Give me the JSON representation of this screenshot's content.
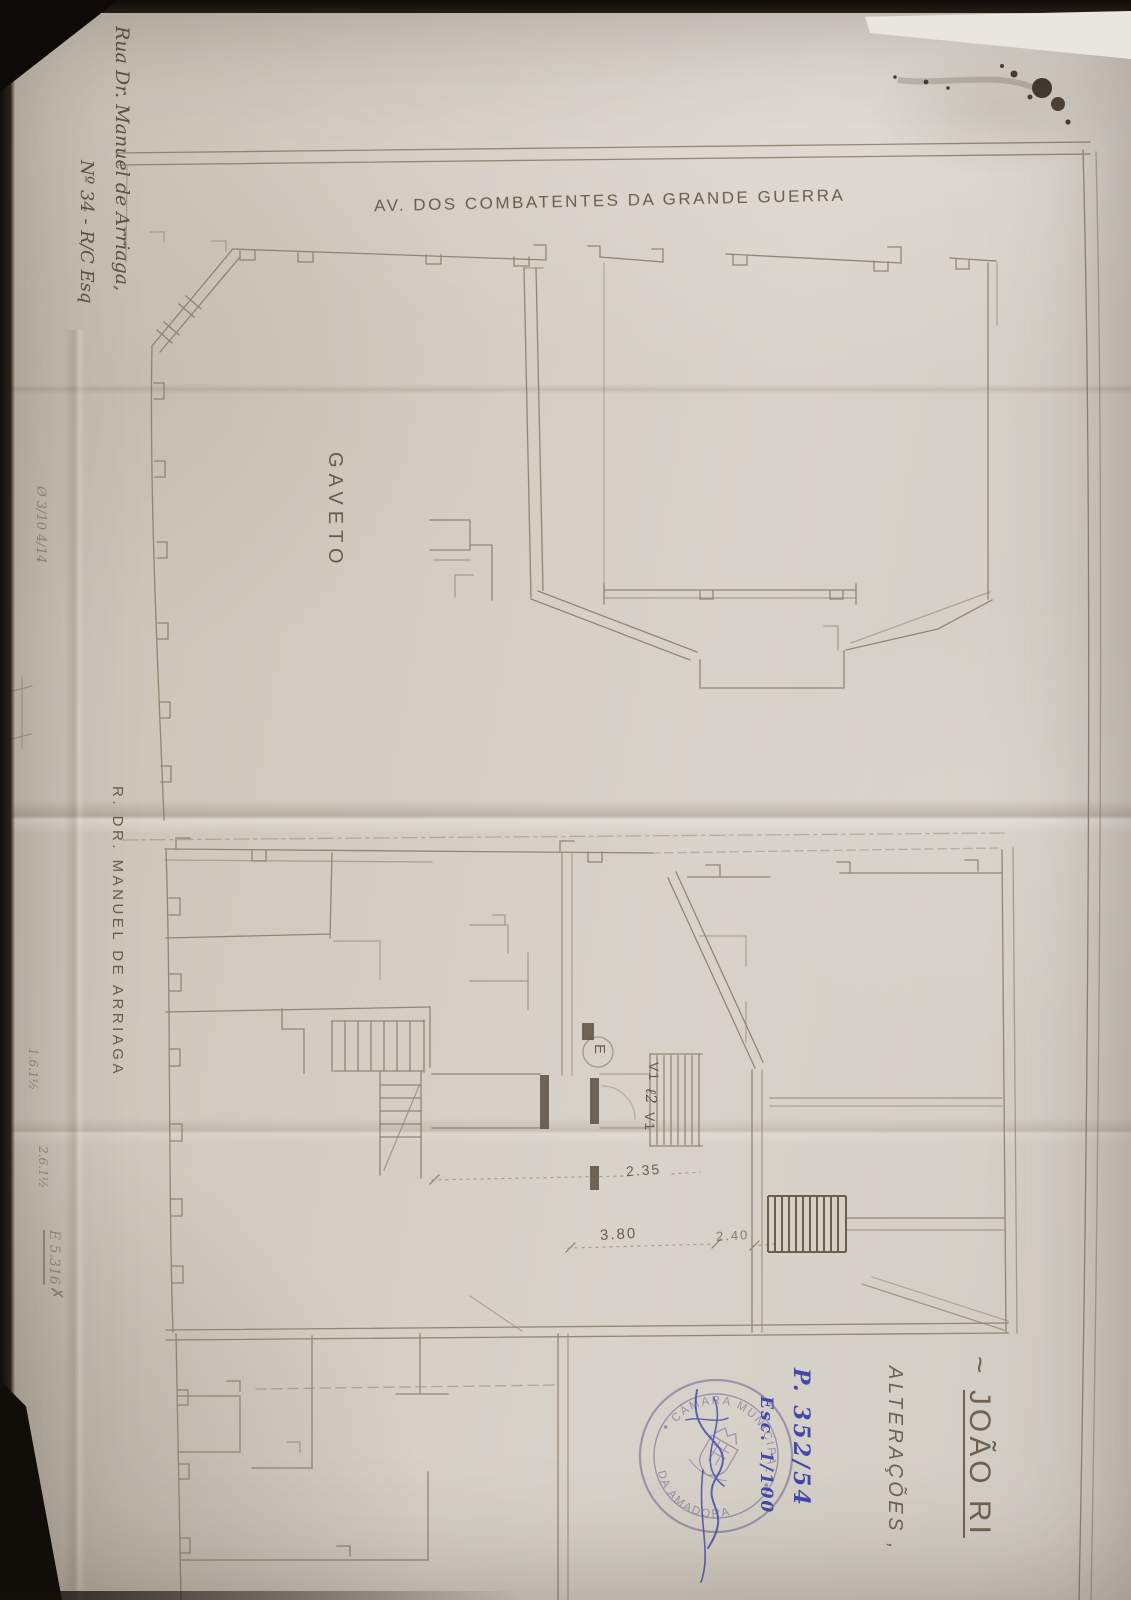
{
  "scan": {
    "street_top_label": "AV. DOS COMBATENTES DA GRANDE GUERRA",
    "corner_block_label": "GAVETO",
    "street_left_label": "R. DR. MANUEL DE ARRIAGA",
    "address_line1": "Rua Dr. Manuel de Arriaga,",
    "address_line2": "Nº 34 - R/C Esq",
    "title_prefix": "~ ",
    "title_name": "JOÃO RI",
    "alterations_label": "ALTERAÇÕES ,",
    "process_number": "P. 352/54",
    "scale_note": "Esc. 1/100",
    "stamp": {
      "arc_top": "CÂMARA MUNICIPAL",
      "arc_bottom": "DA AMADORA"
    },
    "dimensions": {
      "entry_hall": "2.35",
      "left_span": "3.80",
      "right_span": "2.40"
    },
    "plan_labels": {
      "window_upper": "V1",
      "light_shaft": "ℓ2",
      "window_lower": "V1",
      "entry": "E"
    },
    "margin_notes": {
      "left_mid": "Ø 3/10 4/14",
      "bottom_a": "1.6.1½",
      "bottom_b": "2.6.1½",
      "bottom_c": "E 5.316",
      "check": "✗"
    },
    "colors": {
      "paper": "#d5cfc5",
      "plan_line": "#8a7b69",
      "pencil": "#6b5d4c",
      "blue_ink": "#4448ac",
      "stamp_ink": "#8e85a2"
    }
  }
}
